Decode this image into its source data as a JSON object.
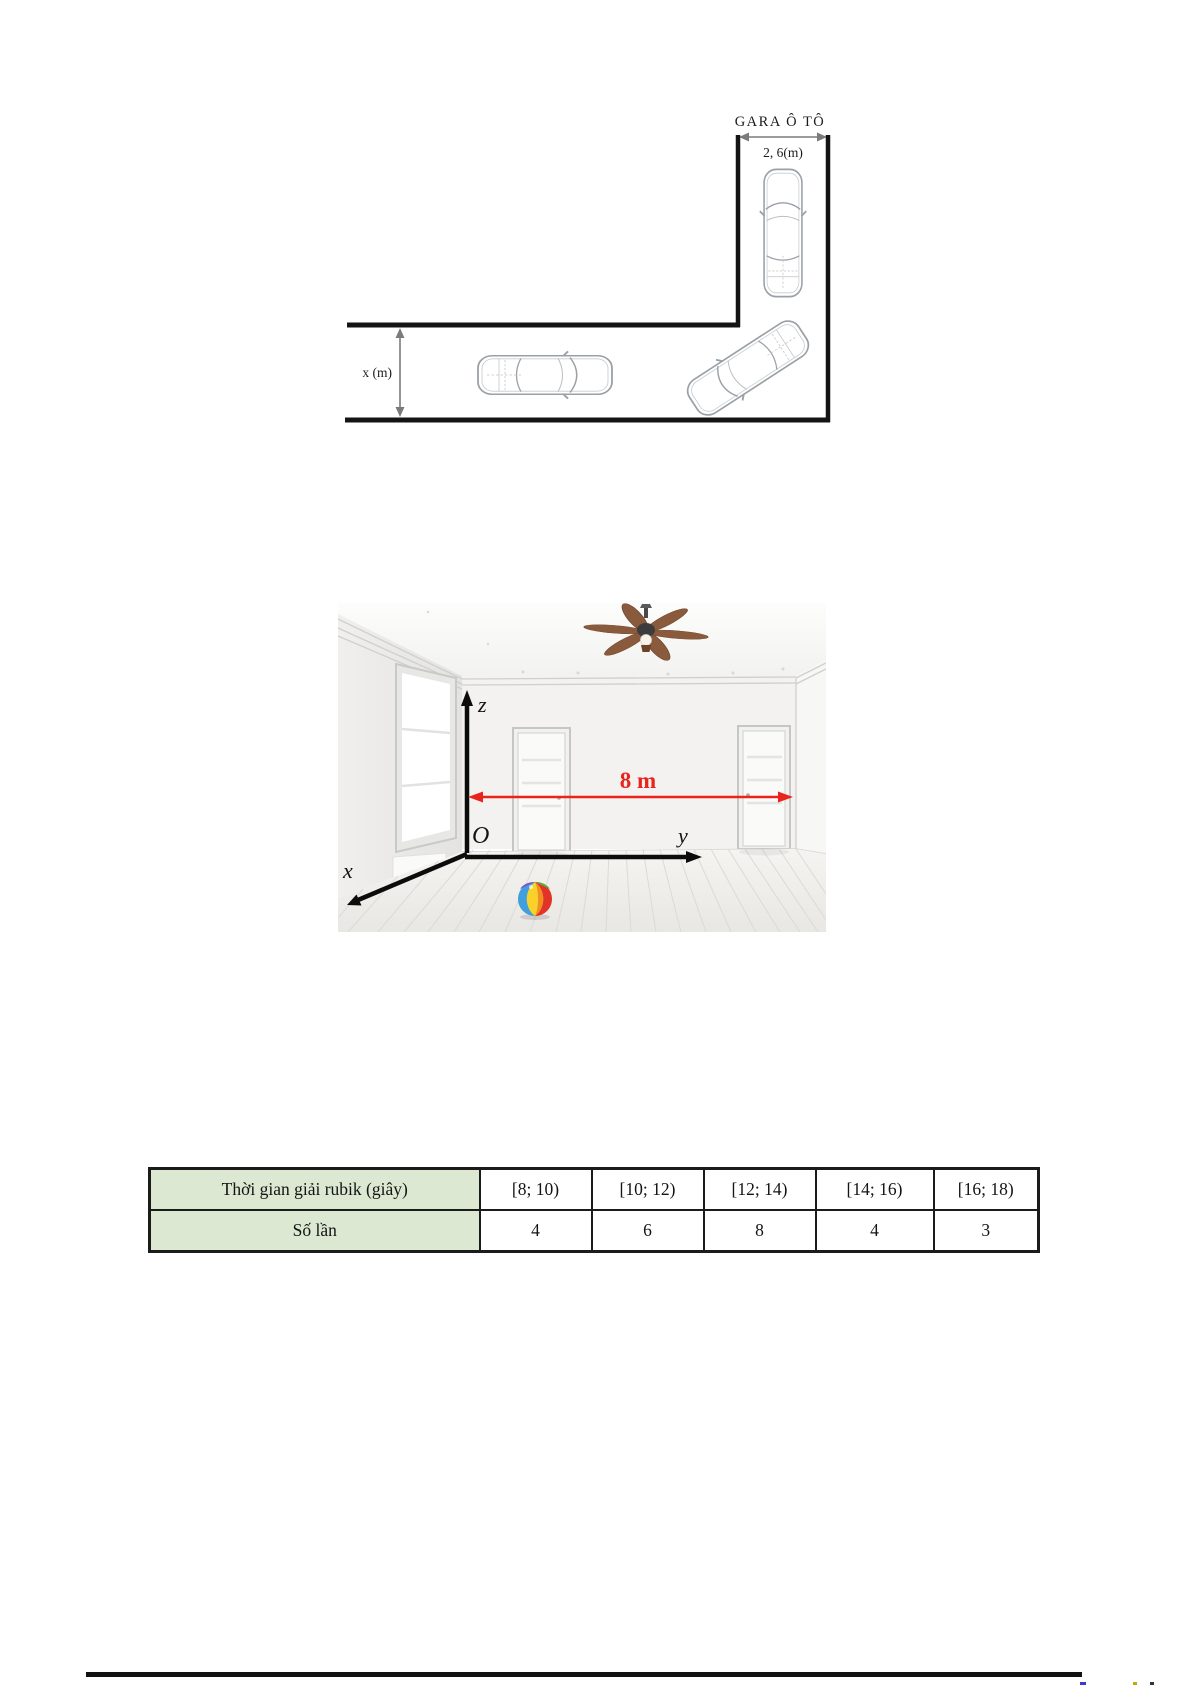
{
  "garage_diagram": {
    "title": "GARA Ô TÔ",
    "garage_width_label": "2, 6(m)",
    "road_width_label": "x (m)"
  },
  "room_figure": {
    "width_label": "8 m",
    "origin_label": "O",
    "axis_x": "x",
    "axis_y": "y",
    "axis_z": "z",
    "accent_red": "#e8241d"
  },
  "frequency_table": {
    "header_bg": "#dce8d2",
    "border_color": "#1b1b1b",
    "rows": [
      {
        "label": "Thời gian giải rubik (giây)",
        "cells": [
          "[8; 10)",
          "[10; 12)",
          "[12; 14)",
          "[14; 16)",
          "[16; 18)"
        ]
      },
      {
        "label": "Số lần",
        "cells": [
          "4",
          "6",
          "8",
          "4",
          "3"
        ]
      }
    ]
  }
}
